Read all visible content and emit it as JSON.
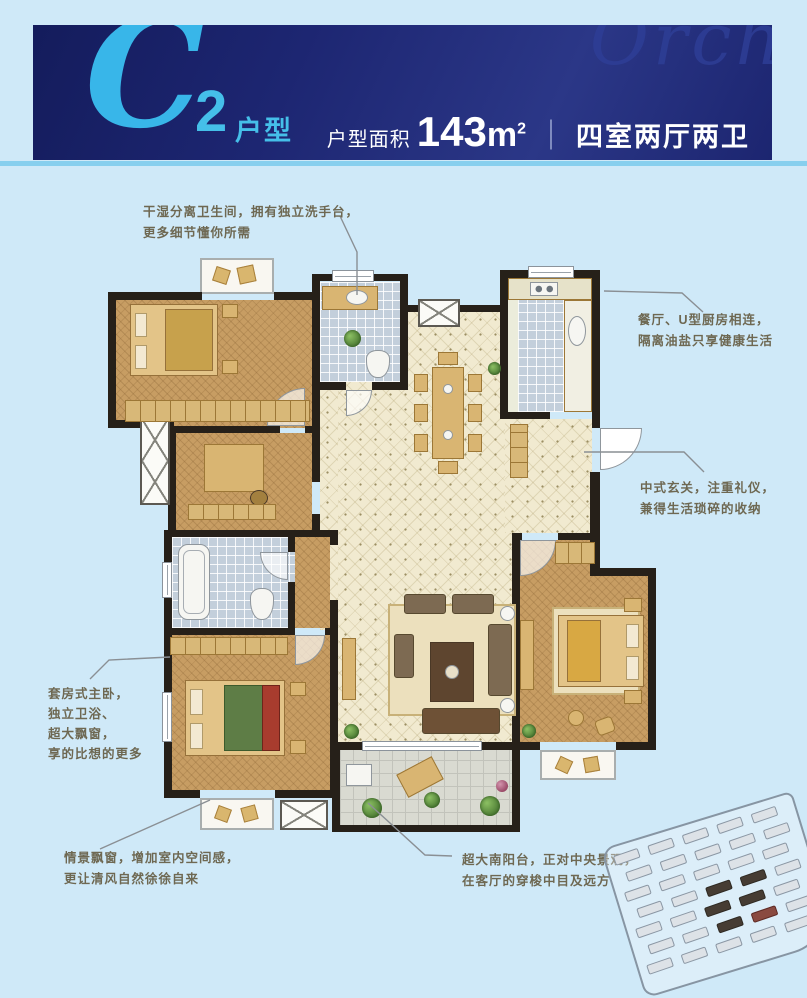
{
  "header": {
    "logo_letter": "C",
    "logo_number": "2",
    "logo_suffix": "户型",
    "area_label": "户型面积",
    "area_value": "143",
    "area_unit_base": "m",
    "area_unit_sup": "2",
    "divider": "｜",
    "rooms_text": "四室两厅两卫",
    "watermark": "Orch",
    "colors": {
      "banner_bg": "#1d2672",
      "accent_cyan": "#3db8e9",
      "stripe": "#87cfee",
      "text": "#ffffff"
    }
  },
  "canvas": {
    "background": "#cfe9f8"
  },
  "floorplan": {
    "wall_color": "#262019",
    "floor_bedroom": "#c79d63",
    "floor_hall": "#f1ead0",
    "floor_bath": "#c3cfdb",
    "floor_balcony": "#d9dad1",
    "floor_kitchen": "#ebecdb",
    "bay_window_color": "#f9f7f1"
  },
  "annotations": {
    "text_color": "#6e6852",
    "leader_color": "#8a8f94",
    "bath_top": {
      "lines": [
        "干湿分离卫生间，拥有独立洗手台，",
        "更多细节懂你所需"
      ]
    },
    "kitchen": {
      "lines": [
        "餐厅、U型厨房相连，",
        "隔离油盐只享健康生活"
      ]
    },
    "entry": {
      "lines": [
        "中式玄关，注重礼仪，",
        "兼得生活琐碎的收纳"
      ]
    },
    "master": {
      "lines": [
        "套房式主卧，",
        "独立卫浴、",
        "超大飘窗，",
        "享的比想的更多"
      ]
    },
    "bay_window": {
      "lines": [
        "情景飘窗，增加室内空间感，",
        "更让清风自然徐徐自来"
      ]
    },
    "balcony": {
      "lines": [
        "超大南阳台，正对中央景观，",
        "在客厅的穿梭中目及远方"
      ]
    }
  },
  "site_plan": {
    "rows": 7,
    "cols": 5,
    "dark_cells": [
      17,
      18,
      22,
      23,
      27
    ],
    "red_cells": [
      28
    ],
    "light": "#dde2e7",
    "dark": "#463c33",
    "red": "#8a4a40",
    "border": "#8b97a4"
  }
}
